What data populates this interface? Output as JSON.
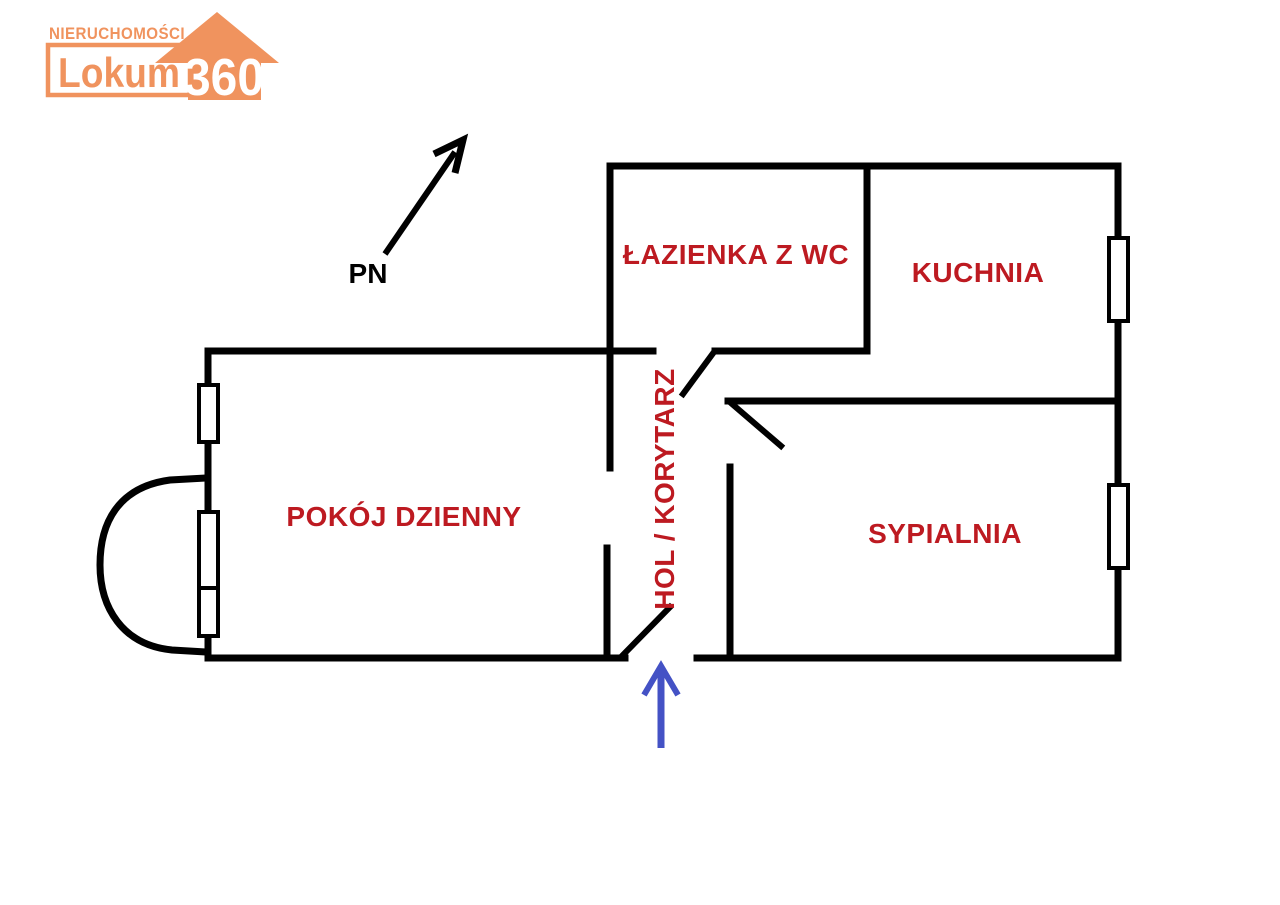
{
  "logo": {
    "brand_top": "NIERUCHOMOŚCI",
    "brand_name": "Lokum",
    "brand_number": "360"
  },
  "compass": {
    "label": "PN"
  },
  "rooms": {
    "bathroom": {
      "label": "ŁAZIENKA Z WC"
    },
    "kitchen": {
      "label": "KUCHNIA"
    },
    "living_room": {
      "label": "POKÓJ DZIENNY"
    },
    "hall": {
      "label": "HOL / KORYTARZ"
    },
    "bedroom": {
      "label": "SYPIALNIA"
    }
  },
  "colors": {
    "wall": "#000000",
    "room_label": "#bd1a21",
    "entrance_arrow": "#4452c5",
    "brand_orange": "#f0935e"
  }
}
